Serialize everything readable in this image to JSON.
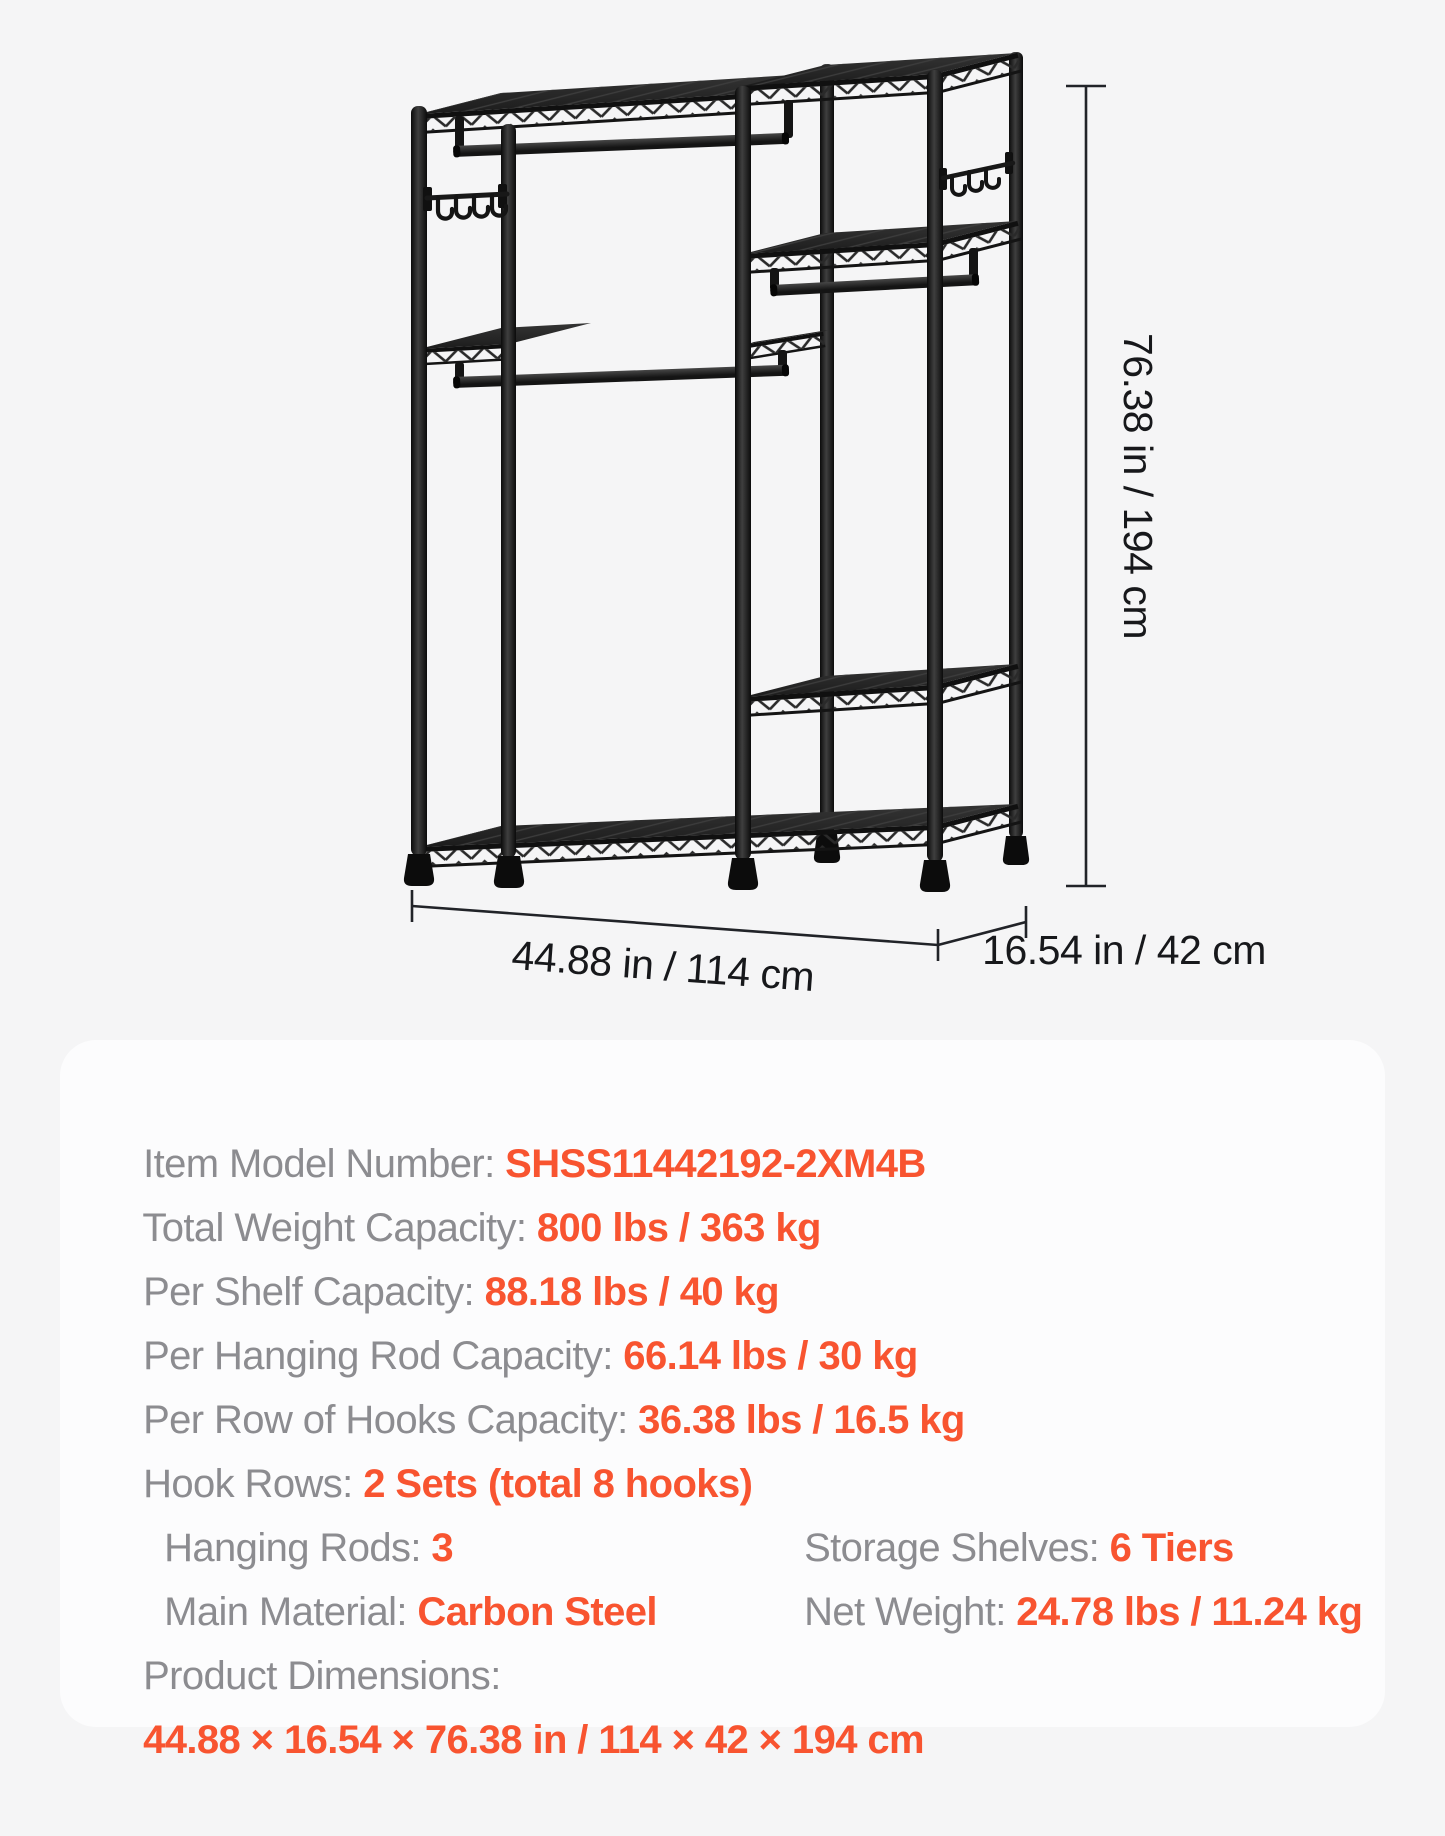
{
  "page": {
    "background": "#f5f5f6"
  },
  "colors": {
    "accent_orange": "#F85430",
    "label_gray": "#8C8C90",
    "dimension_text": "#17181B",
    "rack_black": "#161616",
    "panel_bg": "#fcfcfd"
  },
  "diagram": {
    "height_label": "76.38 in / 194 cm",
    "width_label": "44.88 in / 114 cm",
    "depth_label": "16.54 in / 42 cm"
  },
  "specs": {
    "rows": [
      {
        "label": "Item Model Number: ",
        "value": "SHSS11442192-2XM4B"
      },
      {
        "label": "Total Weight Capacity: ",
        "value": "800 lbs / 363 kg"
      },
      {
        "label": "Per Shelf Capacity: ",
        "value": "88.18 lbs / 40 kg"
      },
      {
        "label": "Per Hanging Rod Capacity: ",
        "value": "66.14 lbs / 30 kg"
      },
      {
        "label": "Per Row of Hooks Capacity: ",
        "value": "36.38 lbs / 16.5 kg"
      },
      {
        "label": "Hook Rows: ",
        "value": "2 Sets (total 8 hooks)"
      }
    ],
    "columns_rows": [
      [
        {
          "label": "Hanging Rods: ",
          "value": "3"
        },
        {
          "label": "Storage Shelves: ",
          "value": "6 Tiers"
        }
      ],
      [
        {
          "label": "Main Material: ",
          "value": "Carbon Steel"
        },
        {
          "label": "Net Weight: ",
          "value": "24.78 lbs / 11.24 kg"
        }
      ]
    ],
    "dimensions_label": "Product Dimensions:",
    "dimensions_value": "44.88 × 16.54 × 76.38 in / 114 × 42 × 194 cm"
  }
}
